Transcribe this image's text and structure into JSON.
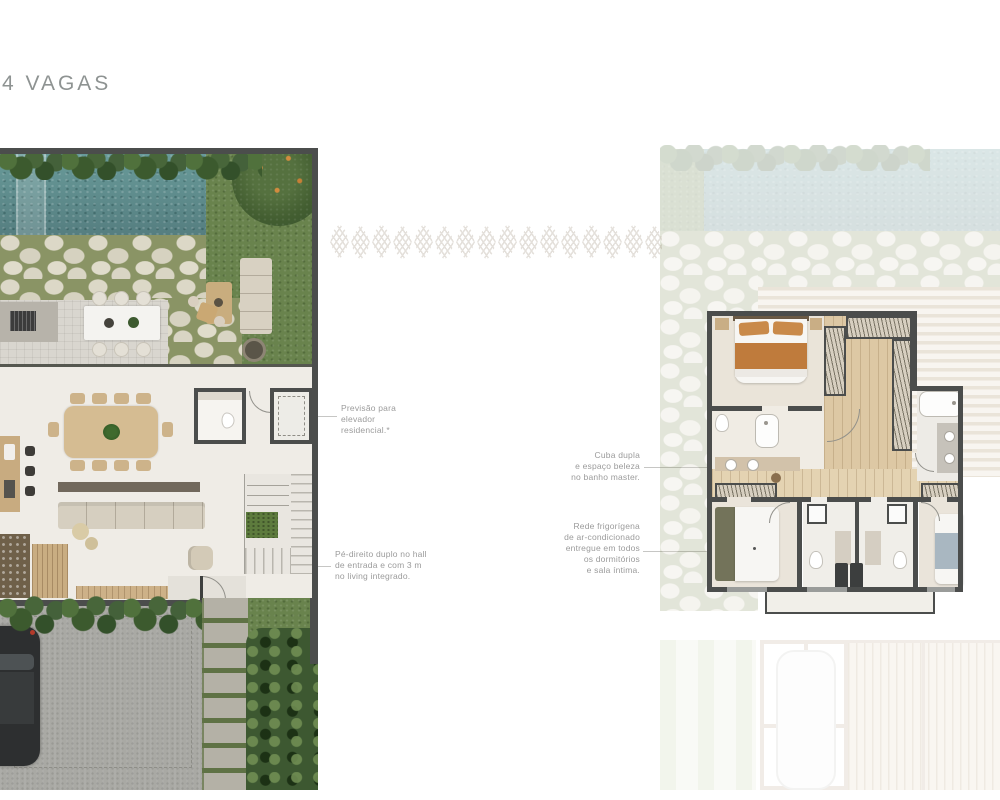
{
  "page": {
    "title": "4 VAGAS"
  },
  "figures": {
    "left_plan": "ground-floor-plan",
    "right_plan": "upper-floor-plan",
    "divider": "leaf-pattern-strip"
  },
  "annotations": {
    "elevator": "Previsão para\nelevador\nresidencial.*",
    "ceiling": "Pé-direito duplo no hall\nde entrada e com 3 m\nno living integrado.",
    "master_bath": "Cuba dupla\ne espaço beleza\nno banho master.",
    "hvac": "Rede frigorígena\nde ar-condicionado\nentregue em todos\nos dormitórios\ne sala íntima."
  },
  "colors": {
    "wall": "#4b4d4c",
    "pool": "#5f9191",
    "lawn": "#69834d",
    "floor": "#efece6",
    "stone": "#dcd8c7",
    "pave": "#a9a9a4",
    "wood": "#d3ba90",
    "bed_orange": "#bf7b3c",
    "bed_olive": "#73735a",
    "bed_blue": "#a9b7c1",
    "ann": "#9b9b9b"
  }
}
